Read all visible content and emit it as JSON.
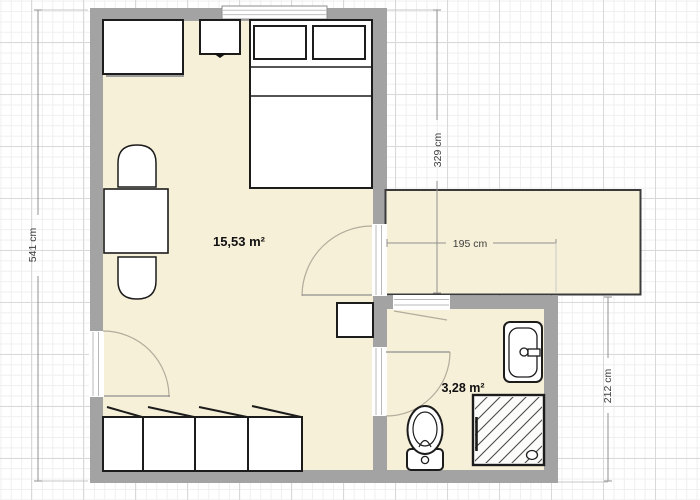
{
  "plan": {
    "rooms": [
      {
        "id": "main-room",
        "area_label": "15,53 m²"
      },
      {
        "id": "bathroom",
        "area_label": "3,28 m²"
      },
      {
        "id": "corridor",
        "area_label": ""
      }
    ],
    "dimensions": [
      {
        "id": "total-height-left",
        "label": "541 cm"
      },
      {
        "id": "upper-height",
        "label": "329 cm"
      },
      {
        "id": "corridor-width",
        "label": "195 cm"
      },
      {
        "id": "lower-height-right",
        "label": "212 cm"
      }
    ],
    "furniture": [
      "wardrobe",
      "nightstand",
      "double-bed",
      "dining-table",
      "chair-top",
      "chair-bottom",
      "side-table",
      "cabinet-row",
      "toilet",
      "sink",
      "shower"
    ],
    "colors": {
      "wall": "#a3a3a3",
      "room_fill": "#f7f0d8",
      "furniture_outline": "#1c1c1c",
      "grid_major": "#d9d9d9",
      "grid_minor": "#efefef",
      "dimension_line": "#909090"
    }
  }
}
